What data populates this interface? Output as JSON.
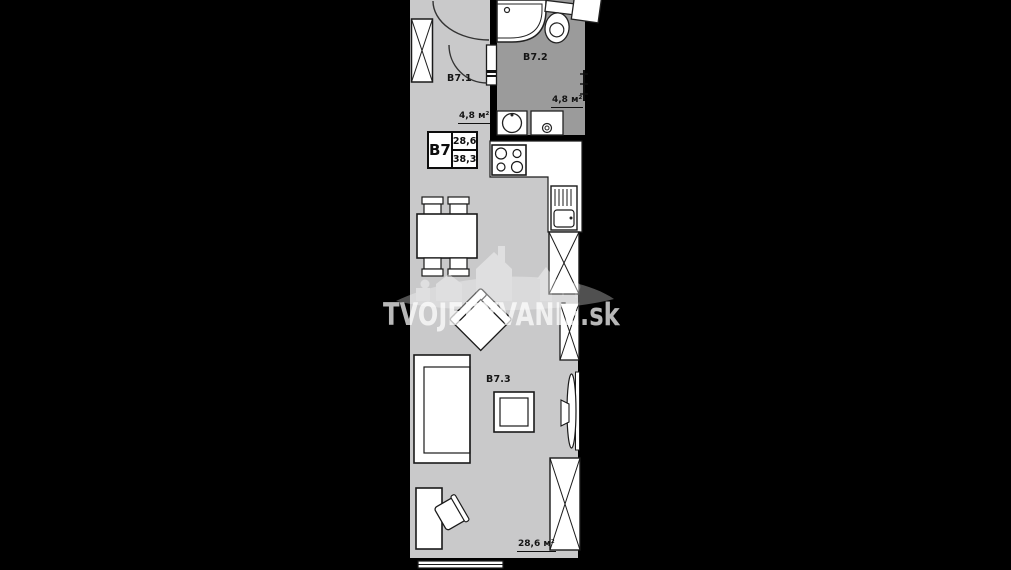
{
  "watermark": {
    "text": "TVOJEBYVANIE.sk"
  },
  "unit_card": {
    "unit": "B7",
    "area_top": "28,6",
    "area_bottom": "38,3"
  },
  "rooms": {
    "hall": {
      "label": "B7.1",
      "area": "4,8 м²"
    },
    "bathroom": {
      "label": "B7.2",
      "area": "4,8 м²"
    },
    "living": {
      "label": "B7.3",
      "area": "28,6 м²"
    }
  },
  "colors": {
    "background": "#000000",
    "floor_light": "#c9c9ca",
    "floor_dark": "#9b9b9b",
    "furniture_fill": "#ffffff",
    "outline": "#1a1a1a",
    "watermark": "rgba(255,255,255,0.72)"
  }
}
